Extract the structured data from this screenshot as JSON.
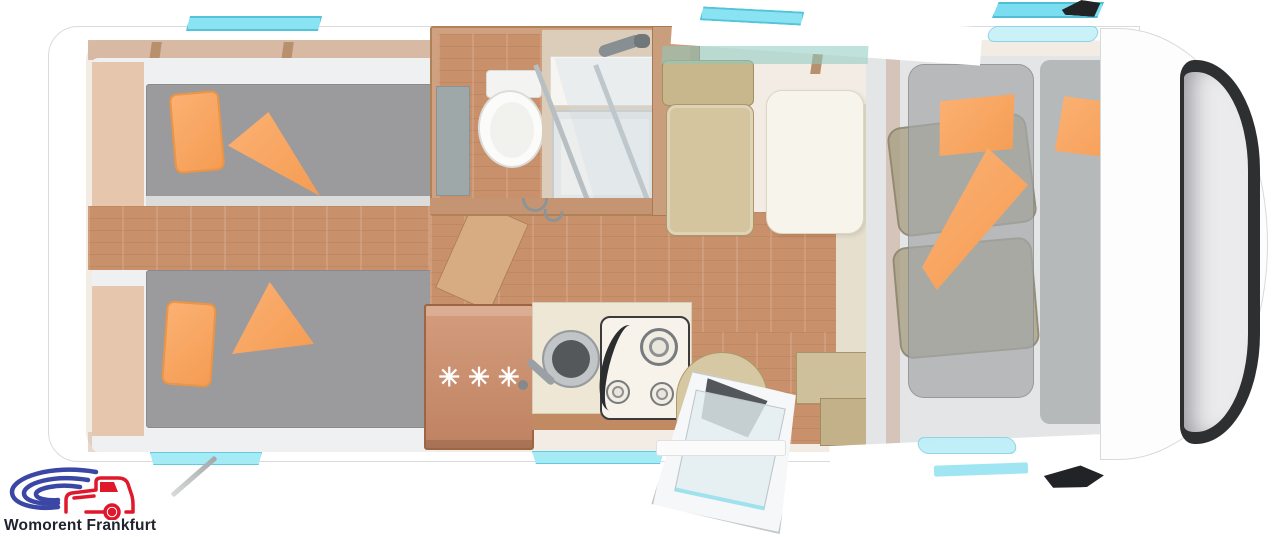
{
  "logo": {
    "text": "Womorent Frankfurt",
    "colors": {
      "red": "#e0182b",
      "blue": "#3a47a5",
      "text": "#20232e"
    }
  },
  "fridge": {
    "symbols": "✳✳✳"
  },
  "palette": {
    "accent_cyan": "#8ae3f2",
    "pillow_orange": "#f8a75f",
    "mattress_gray": "#9b9b9d",
    "wood_floor": "#c9916b",
    "upholstery_tan": "#d4c59f",
    "windshield_dark": "#2e2f31",
    "body_white": "#ffffff"
  }
}
